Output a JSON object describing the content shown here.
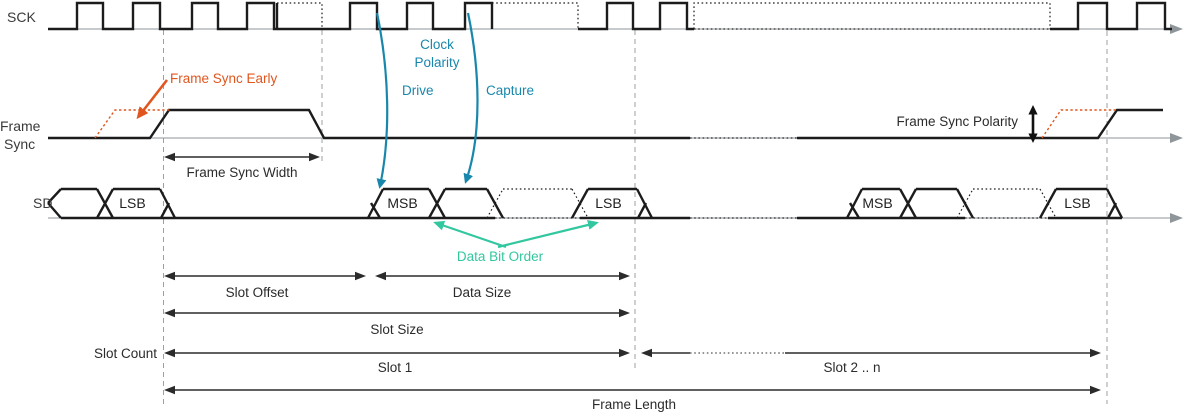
{
  "colors": {
    "waveform": "#1c1c1c",
    "baseline_gray": "#8f9699",
    "grid_gray": "#9aa0a3",
    "accent_orange": "#E0561F",
    "accent_blue": "#1987AC",
    "accent_teal": "#33C7A0",
    "text_dark": "#2b2b2b"
  },
  "signals": {
    "sck": {
      "label": "SCK"
    },
    "frame_sync": {
      "label_lines": [
        "Frame",
        "Sync"
      ]
    },
    "sd": {
      "label": "SD"
    }
  },
  "annotations": {
    "frame_sync_early": "Frame Sync Early",
    "clock_polarity_lines": [
      "Clock",
      "Polarity"
    ],
    "drive": "Drive",
    "capture": "Capture",
    "frame_sync_width": "Frame Sync Width",
    "frame_sync_polarity": "Frame Sync Polarity",
    "data_bit_order": "Data Bit Order",
    "slot_offset": "Slot Offset",
    "data_size": "Data Size",
    "slot_size": "Slot Size",
    "slot_count": "Slot Count",
    "slot_1": "Slot 1",
    "slot_2_n": "Slot 2 .. n",
    "frame_length": "Frame Length"
  },
  "waveforms": {
    "rows": [
      {
        "name": "sck",
        "base_y": 29
      },
      {
        "name": "frame_sync",
        "base_y": 138
      },
      {
        "name": "sd",
        "base_y": 218
      }
    ],
    "sck": {
      "solid": "M48 29 H77 V3 H103 V29 H133 V3 H160 V29 H192 V3 H218 V29 H247 V3 H274 V29 H350 V3 H377 V29 H407 V3 H433 V29 H465 V3 H492 V29 M277 29 V3 M578 29 H607 V3 H633 V29 H660 V3 H687 V29 H694 M1050 29 H1078 V3 H1107 V29 H1137 V3 H1165 V29 H1172",
      "dotted": "M277 3 H322 V29 M492 3 H578 V29 M694 29 V3 H1050 V29 M694 29 H1050"
    },
    "frame_sync": {
      "solid": "M48 138 H150 L169 110 H309 L324 138 H690 M797 138 H1098 L1117 110 H1163",
      "dotted": "M690 138 H797",
      "orange_dotted": "M95 138 L115 110 H170 M1042 138 L1061 110 H1118"
    },
    "sd": {
      "solid_low": "M175 218 H368 M652 218 H690 M797 218 H847",
      "dotted_low": "M690 218 H797"
    }
  },
  "sd_groups": [
    {
      "open": 48,
      "open_type": "mid",
      "bounds": [
        105
      ],
      "end": 160,
      "cells": [
        {
          "label": "",
          "style": "solid"
        },
        {
          "label": "LSB",
          "style": "solid"
        }
      ]
    },
    {
      "open": 368,
      "open_type": "low",
      "bounds": [
        437,
        495,
        580
      ],
      "end": 637,
      "cells": [
        {
          "label": "MSB",
          "style": "solid"
        },
        {
          "label": "",
          "style": "solid"
        },
        {
          "label": "",
          "style": "dotted"
        },
        {
          "label": "LSB",
          "style": "solid"
        }
      ]
    },
    {
      "open": 847,
      "open_type": "low",
      "bounds": [
        908,
        965,
        1048
      ],
      "end": 1107,
      "cells": [
        {
          "label": "MSB",
          "style": "solid"
        },
        {
          "label": "",
          "style": "solid"
        },
        {
          "label": "",
          "style": "dotted"
        },
        {
          "label": "LSB",
          "style": "solid"
        }
      ]
    }
  ],
  "dimensions": [
    {
      "key": "frame_sync_width",
      "x1": 164,
      "x2": 320,
      "y": 157
    },
    {
      "key": "slot_offset",
      "x1": 164,
      "x2": 366,
      "y": 276
    },
    {
      "key": "data_size",
      "x1": 375,
      "x2": 630,
      "y": 276
    },
    {
      "key": "slot_size",
      "x1": 164,
      "x2": 630,
      "y": 313
    },
    {
      "key": "slot_1",
      "x1": 164,
      "x2": 630,
      "y": 353
    },
    {
      "key": "slot_2_n",
      "x1": 641,
      "x2": 1101,
      "y": 353,
      "dotted_span": [
        690,
        785
      ]
    },
    {
      "key": "frame_length",
      "x1": 164,
      "x2": 1101,
      "y": 390
    }
  ],
  "gridlines": [
    {
      "x": 163.5,
      "y1": 30,
      "y2": 406
    },
    {
      "x": 322,
      "y1": 30,
      "y2": 163
    },
    {
      "x": 635,
      "y1": 30,
      "y2": 371
    },
    {
      "x": 1107,
      "y1": 31,
      "y2": 404
    }
  ]
}
